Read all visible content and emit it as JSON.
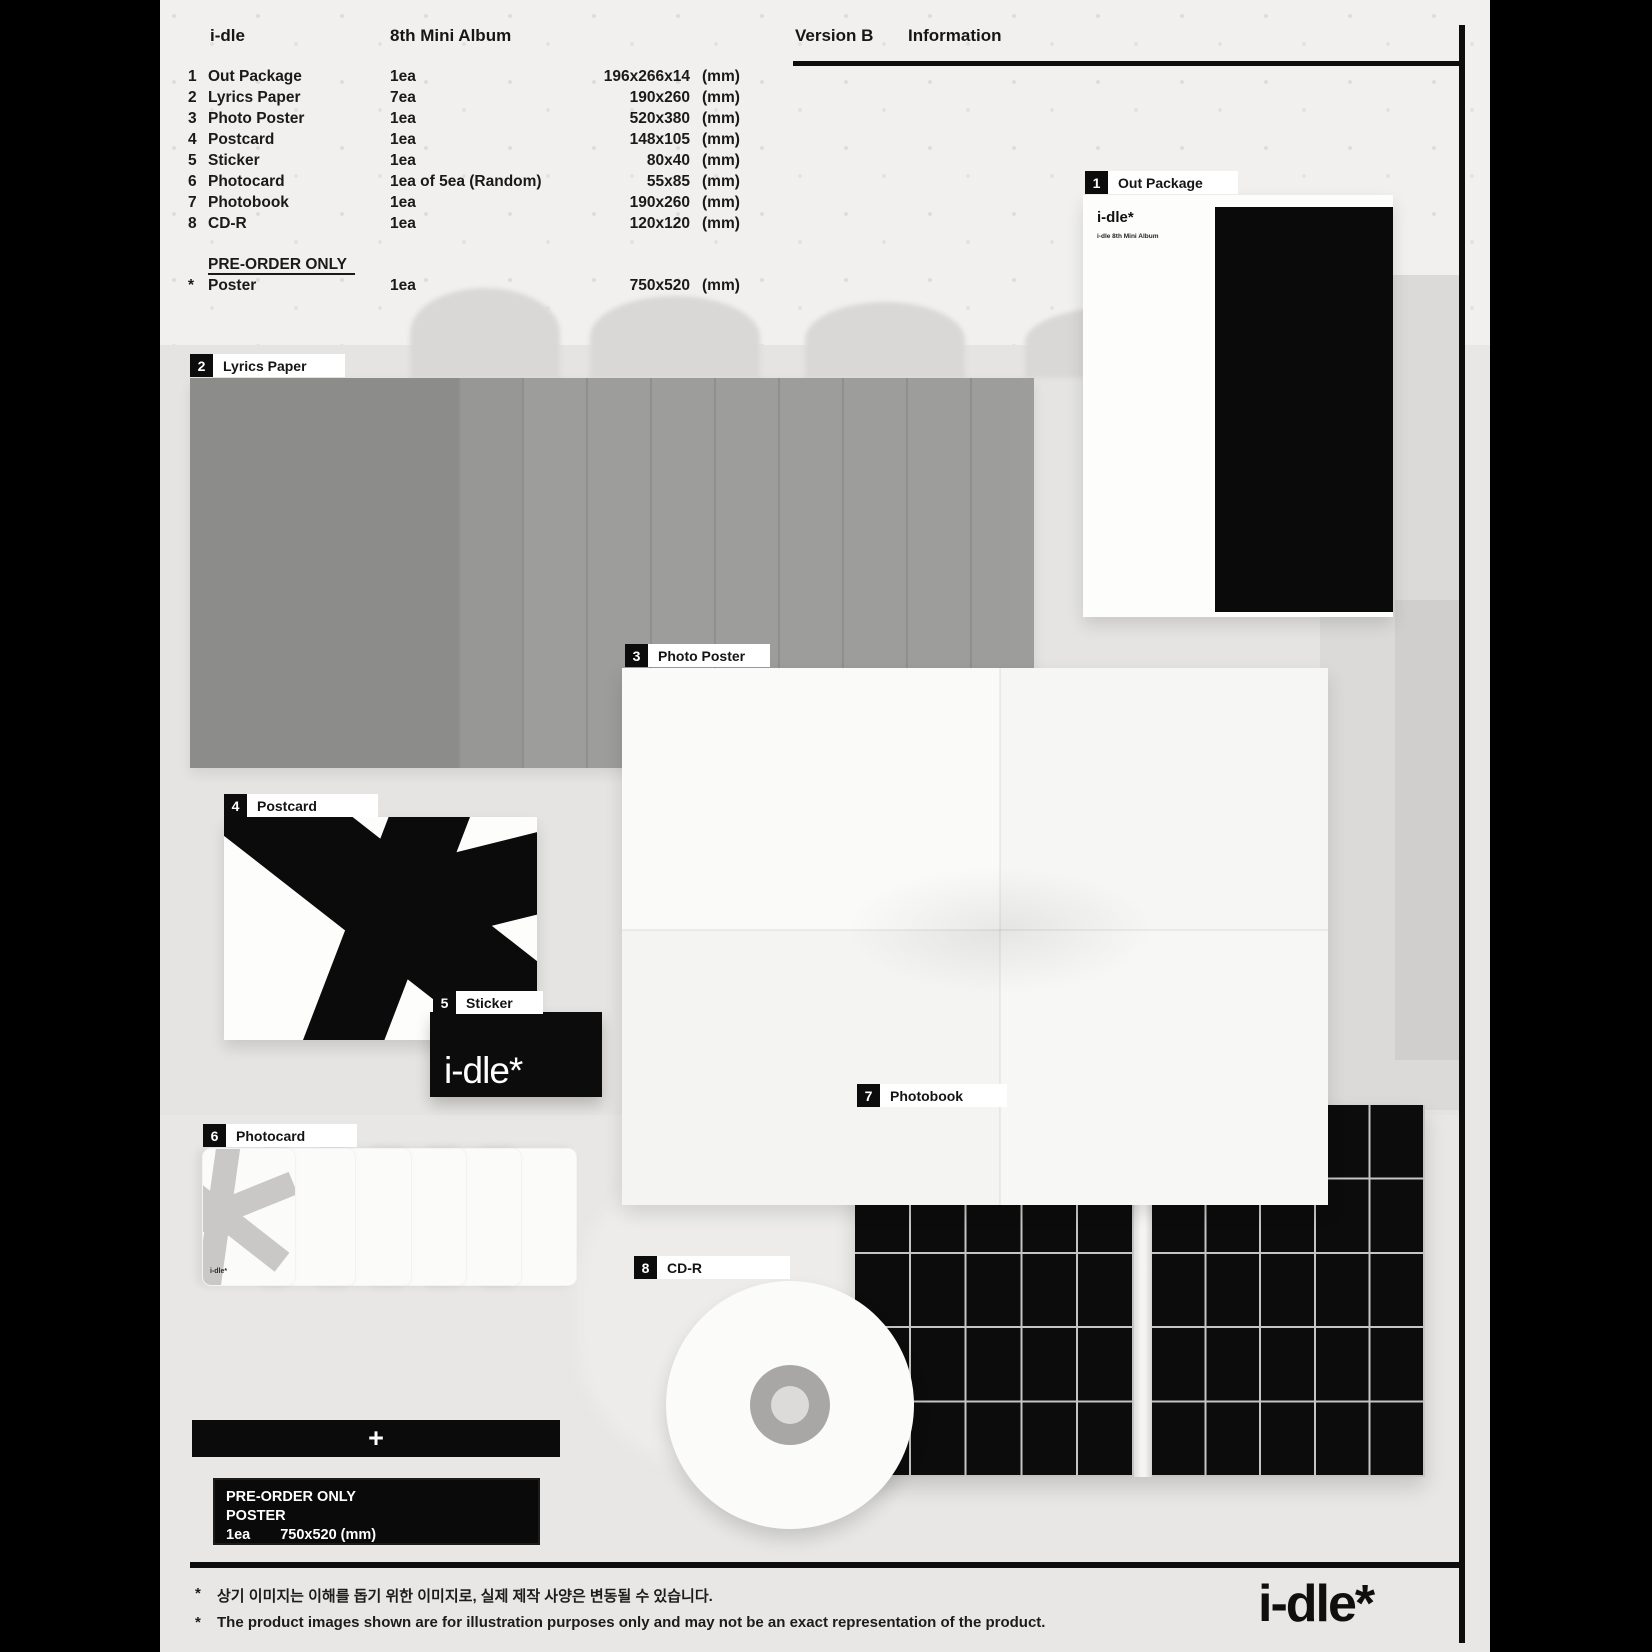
{
  "header": {
    "brand": "i-dle",
    "album": "8th Mini Album",
    "version": "Version B",
    "info_label": "Information"
  },
  "spec": {
    "items": [
      {
        "num": "1",
        "name": "Out Package",
        "qty": "1ea",
        "size": "196x266x14",
        "unit": "(mm)"
      },
      {
        "num": "2",
        "name": "Lyrics Paper",
        "qty": "7ea",
        "size": "190x260",
        "unit": "(mm)"
      },
      {
        "num": "3",
        "name": "Photo Poster",
        "qty": "1ea",
        "size": "520x380",
        "unit": "(mm)"
      },
      {
        "num": "4",
        "name": "Postcard",
        "qty": "1ea",
        "size": "148x105",
        "unit": "(mm)"
      },
      {
        "num": "5",
        "name": "Sticker",
        "qty": "1ea",
        "size": "80x40",
        "unit": "(mm)"
      },
      {
        "num": "6",
        "name": "Photocard",
        "qty": "1ea of 5ea (Random)",
        "size": "55x85",
        "unit": "(mm)"
      },
      {
        "num": "7",
        "name": "Photobook",
        "qty": "1ea",
        "size": "190x260",
        "unit": "(mm)"
      },
      {
        "num": "8",
        "name": "CD-R",
        "qty": "1ea",
        "size": "120x120",
        "unit": "(mm)"
      }
    ],
    "preorder_heading": "PRE-ORDER ONLY",
    "preorder_item": {
      "num": "*",
      "name": "Poster",
      "qty": "1ea",
      "size": "750x520",
      "unit": "(mm)"
    }
  },
  "sections": {
    "out_package": {
      "num": "1",
      "label": "Out Package"
    },
    "lyrics_paper": {
      "num": "2",
      "label": "Lyrics Paper"
    },
    "photo_poster": {
      "num": "3",
      "label": "Photo Poster"
    },
    "postcard": {
      "num": "4",
      "label": "Postcard"
    },
    "sticker": {
      "num": "5",
      "label": "Sticker"
    },
    "photocard": {
      "num": "6",
      "label": "Photocard"
    },
    "photobook": {
      "num": "7",
      "label": "Photobook"
    },
    "cd_r": {
      "num": "8",
      "label": "CD-R"
    }
  },
  "out_package_card": {
    "logo": "i-dle*",
    "subtitle": "i-dle 8th Mini Album"
  },
  "sticker_item": {
    "text": "i-dle*"
  },
  "photocard_item": {
    "logo": "i-dle*"
  },
  "plus_bar": {
    "symbol": "+"
  },
  "preorder_box": {
    "title": "PRE-ORDER ONLY",
    "item": "POSTER",
    "qty": "1ea",
    "size": "750x520 (mm)"
  },
  "footnotes": {
    "mark": "*",
    "korean": "상기 이미지는 이해를 돕기 위한 이미지로, 실제 제작 사양은 변동될 수 있습니다.",
    "english": "The product images shown are for illustration purposes only and may not be an exact representation of the product."
  },
  "footer": {
    "logo": "i-dle*"
  },
  "colors": {
    "page_bg": "#e8e7e5",
    "ink": "#111111",
    "sheet_dark": "#8c8c8b",
    "sheet_light": "#9d9d9c",
    "black_panel": "#0a0a0a",
    "grid_line": "#c6c5c4"
  }
}
